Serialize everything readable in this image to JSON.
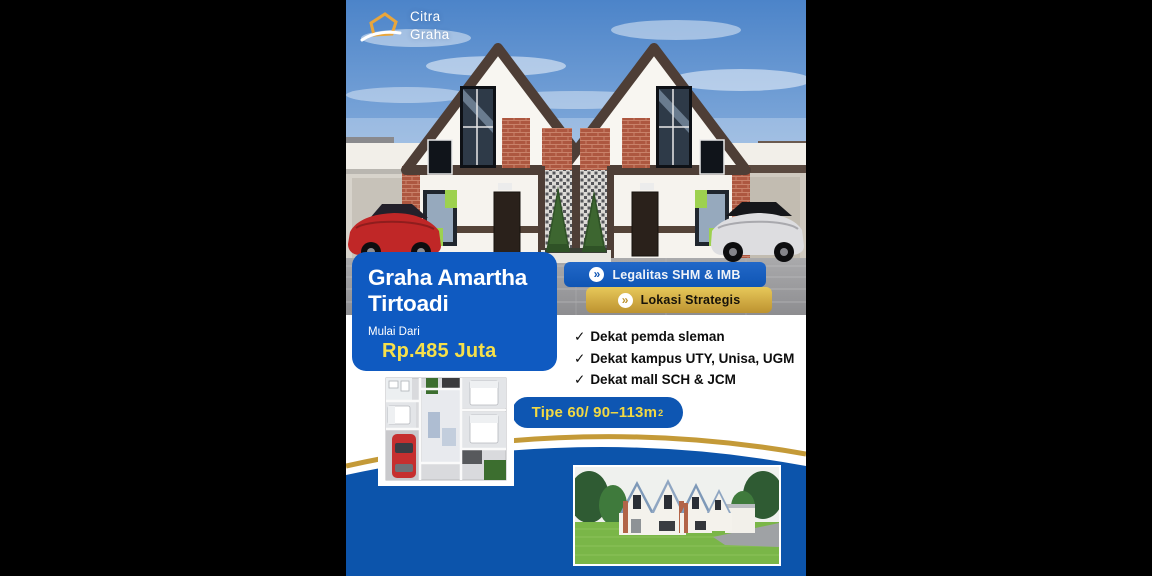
{
  "brand": {
    "logo_icon": "house-outline-swoosh-icon",
    "name_lines": [
      "Citra",
      "Graha"
    ]
  },
  "title_card": {
    "title_lines": [
      "Graha Amartha",
      "Tirtoadi"
    ],
    "price_label": "Mulai Dari",
    "price_value": "Rp.485 Juta"
  },
  "badges": [
    {
      "label": "Legalitas SHM & IMB",
      "style": "blue",
      "icon": "chevron-right-circle-icon",
      "icon_glyph": "»"
    },
    {
      "label": "Lokasi Strategis",
      "style": "gold",
      "icon": "chevron-right-circle-icon",
      "icon_glyph": "»"
    }
  ],
  "features": {
    "check_glyph": "✓",
    "items": [
      "Dekat pemda sleman",
      "Dekat kampus UTY, Unisa, UGM",
      "Dekat mall SCH & JCM"
    ]
  },
  "type_pill": {
    "text": "Tipe 60/ 90–113m",
    "superscript": "2"
  },
  "images": {
    "hero": "twin-gable-house-exterior-render",
    "floor_plan": "floor-plan-top-view-with-red-car",
    "bottom_render": "housing-row-exterior-render"
  },
  "colors": {
    "canvas_black": "#000000",
    "card_blue": "#0f5ac1",
    "swoosh_blue": "#0c54ab",
    "pill_blue": "#0e56b2",
    "accent_gold": "#bd9330",
    "accent_gold_light": "#e7c85a",
    "accent_yellow": "#f6e04a",
    "text_dark": "#0d0d0d",
    "white": "#ffffff"
  }
}
